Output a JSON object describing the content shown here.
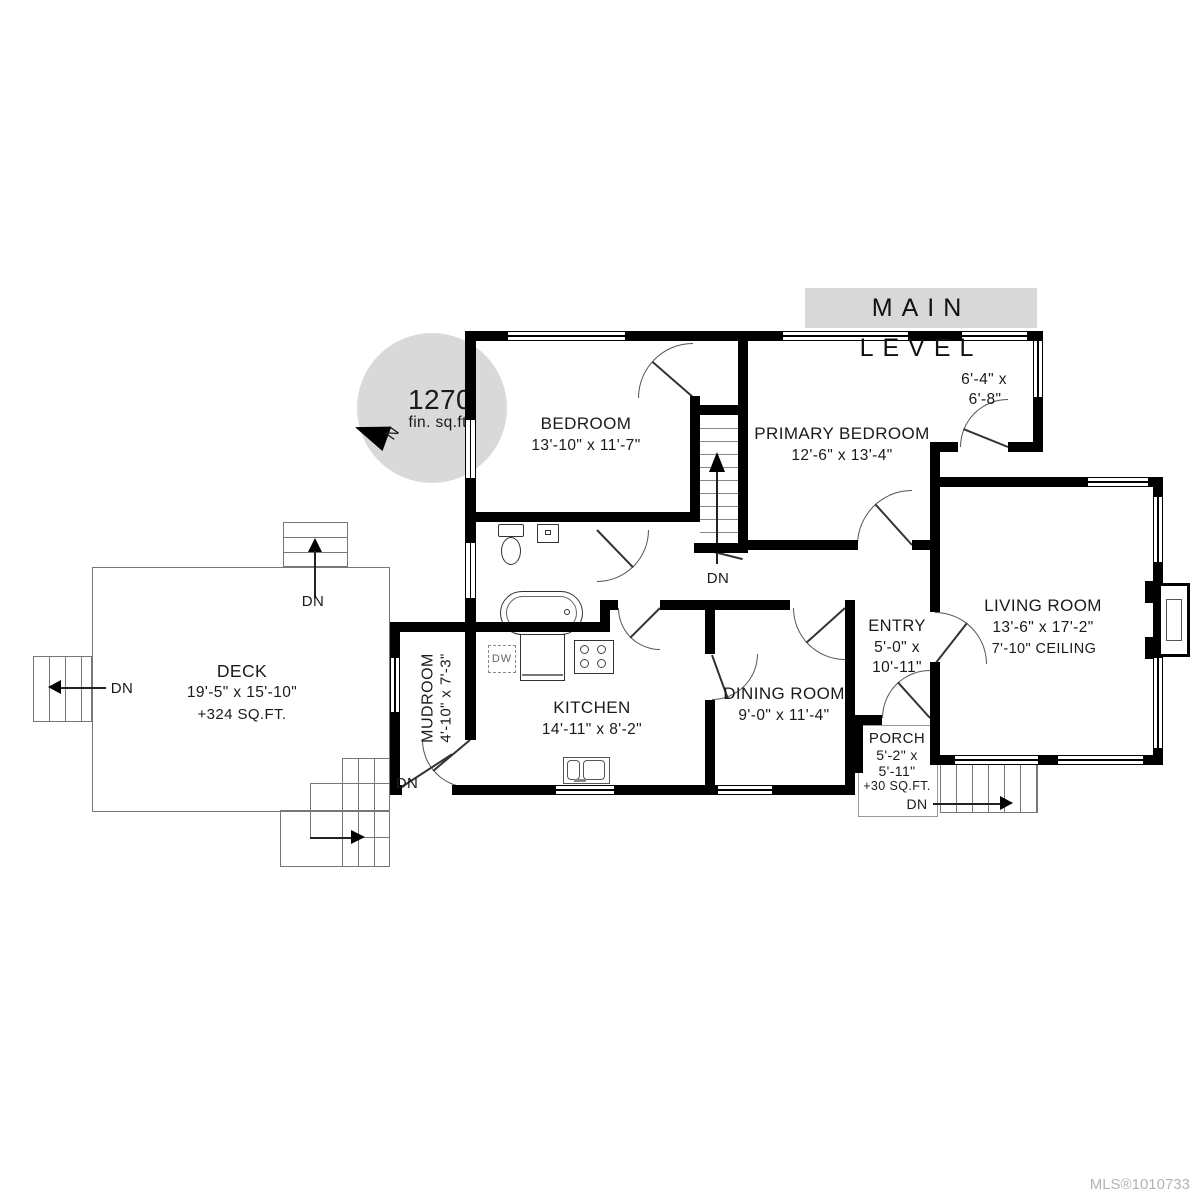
{
  "title": "MAIN LEVEL",
  "compass": {
    "area_value": "1270",
    "area_unit": "fin. sq.ft.",
    "north": "N"
  },
  "labels": {
    "down": "DN",
    "dishwasher": "DW"
  },
  "rooms": {
    "bedroom": {
      "name": "BEDROOM",
      "dims": "13'-10\" x 11'-7\""
    },
    "primary_bedroom": {
      "name": "PRIMARY BEDROOM",
      "dims": "12'-6\" x 13'-4\""
    },
    "closet_nook": {
      "dims_line1": "6'-4\" x",
      "dims_line2": "6'-8\""
    },
    "living_room": {
      "name": "LIVING ROOM",
      "dims": "13'-6\" x 17'-2\"",
      "ceiling": "7'-10\" CEILING"
    },
    "entry": {
      "name": "ENTRY",
      "dims_line1": "5'-0\" x",
      "dims_line2": "10'-11\""
    },
    "dining_room": {
      "name": "DINING ROOM",
      "dims": "9'-0\" x 11'-4\""
    },
    "kitchen": {
      "name": "KITCHEN",
      "dims": "14'-11\" x 8'-2\""
    },
    "mudroom": {
      "name": "MUDROOM",
      "dims": "4'-10\" x 7'-3\""
    },
    "deck": {
      "name": "DECK",
      "dims": "19'-5\" x 15'-10\"",
      "extra": "+324 SQ.FT."
    },
    "porch": {
      "name": "PORCH",
      "dims_line1": "5'-2\" x",
      "dims_line2": "5'-11\"",
      "extra": "+30 SQ.FT."
    }
  },
  "footer": {
    "mls": "MLS®1010733"
  },
  "colors": {
    "wall": "#000000",
    "title_bg": "#d8d8d8",
    "compass_bg": "#d9d9d9",
    "mls": "#b4b4b4"
  }
}
